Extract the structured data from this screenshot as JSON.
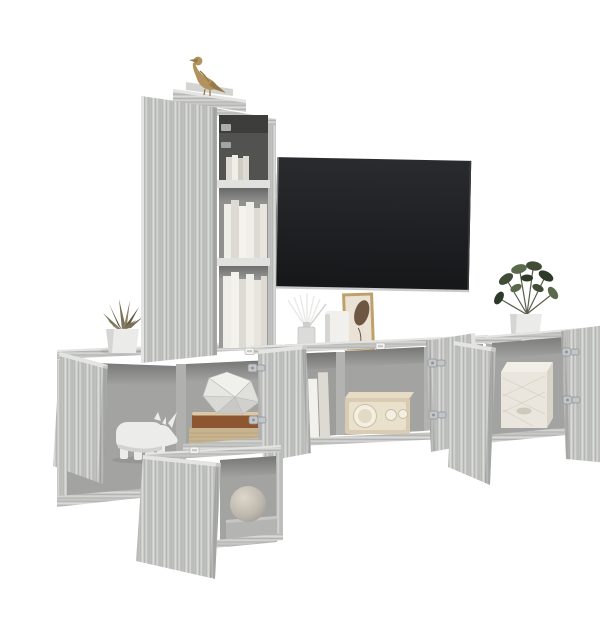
{
  "canvas": {
    "width": 600,
    "height": 600,
    "background": "#ffffff"
  },
  "colors": {
    "wall": "#ffffff",
    "wood_base": "#c7c8c6",
    "wood_light": "#dadbd9",
    "wood_mid": "#b2b3b1",
    "wood_dark": "#9b9c9a",
    "wood_edge": "#e4e5e3",
    "interior_back": "#a3a4a2",
    "interior_dark": "#525250",
    "shelf_front": "#e1e2e0",
    "tv_screen_top": "#2a2b2e",
    "tv_screen_bottom": "#161719",
    "tv_edge": "#c9cacc",
    "bird_gold": "#b2935d",
    "bird_gold_dark": "#97794a",
    "succulent_green": "#7b7157",
    "succulent_dark": "#645b45",
    "plant_green": "#414c37",
    "plant_green_light": "#5a684c",
    "plant_green_dark": "#2e3a29",
    "pot_white": "#ebecea",
    "pot_shade": "#d5d6d4",
    "rhino_white": "#ecedeb",
    "rhino_shade": "#d2d3d1",
    "book_cream": "#efeee8",
    "book_grey": "#dcdad2",
    "book_brown": "#8e5531",
    "book_tan": "#c7b38e",
    "page_edge": "#d9c9a8",
    "poly_white": "#e9eae6",
    "file_white": "#f2f1eb",
    "radio_body": "#d9ccb3",
    "radio_face": "#eae1cd",
    "radio_ring": "#f4efe2",
    "basket_white": "#eae6dd",
    "basket_side": "#d9d4c8",
    "frame_gold": "#c0a06a",
    "art_paper": "#eae2d4",
    "art_leaf": "#6d5642",
    "vase_white": "#f1f0ec",
    "glass": "#d8d9d7",
    "stick_white": "#e9e9e7",
    "hinge_metal": "#c3c6c9",
    "hinge_dark": "#8e9194",
    "bracket_white": "#f2f3f1"
  },
  "scene": {
    "type": "product-photo",
    "subject": "5-piece wall-mounted TV media cabinet set in grey sonoma wood, styled with decor, white background",
    "objects": [
      {
        "name": "tall-wall-cabinet",
        "note": "vertical cabinet, long door open, three open shelves with books, gold bird figurine on top"
      },
      {
        "name": "flat-screen-tv",
        "note": "black wall-mounted television"
      },
      {
        "name": "left-cube-cabinets",
        "note": "open door cube with white rhino figurine, shelf with stacked books and white geometric ornament, succulent in white pot on top"
      },
      {
        "name": "tv-bench-cabinet",
        "note": "wall-hung bench, two doors open, white magazine files and beige radio inside, reed diffuser, white vase and framed art on top"
      },
      {
        "name": "right-wall-cabinet",
        "note": "doors open, white woven basket inside, green plant in white pot on top"
      },
      {
        "name": "bottom-cube-cabinet",
        "note": "open door, round stone vase on grey plinth inside"
      }
    ]
  }
}
